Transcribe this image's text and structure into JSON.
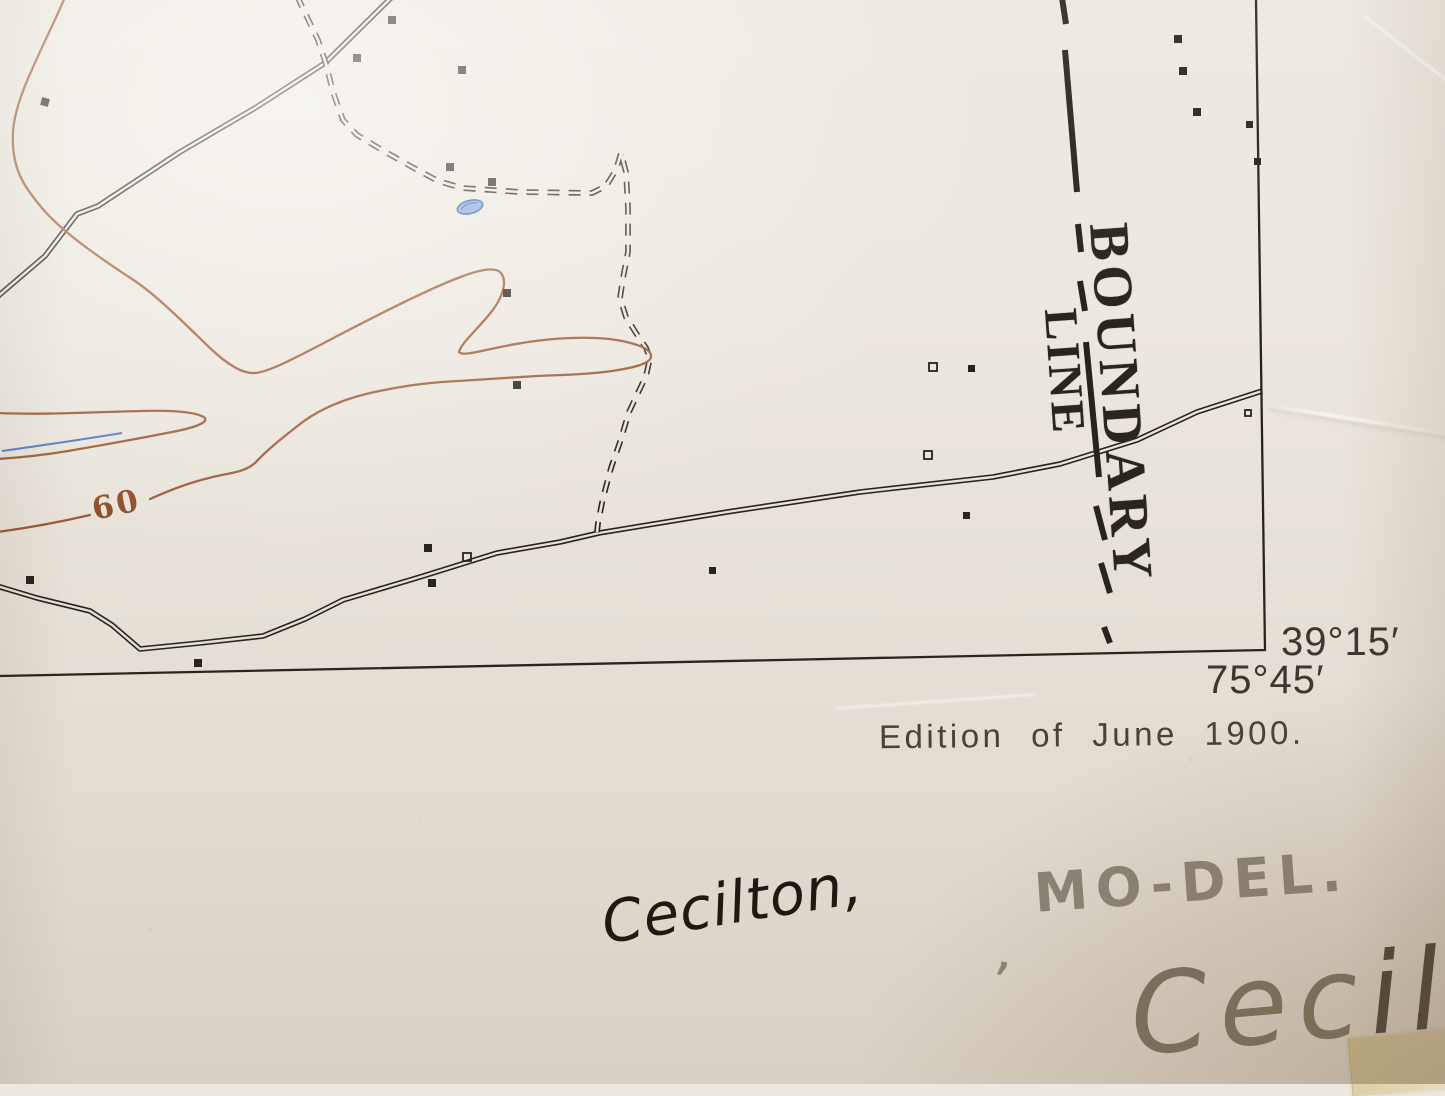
{
  "colors": {
    "paper": "#ece7df",
    "ink": "#26231d",
    "contour_brown": "#9c5a36",
    "water_blue": "#4b7bc2",
    "pencil_gray": "#8f897f",
    "handwriting_ink": "#15120d",
    "tape_yellow": "#d9c48e"
  },
  "map": {
    "boundary_label": {
      "line1": "BOUNDARY",
      "line2": "LINE"
    },
    "contour_label": "60",
    "corner_coordinates": {
      "latitude": "39°15′",
      "longitude": "75°45′"
    },
    "edition_note": "Edition of June 1900."
  },
  "annotations": {
    "handwritten_title_ink": "Cecilton,",
    "handwritten_state_pencil": "MO-DEL.",
    "pencil_mark": ",",
    "partial_pencil_light": "Cec",
    "partial_pencil_dark": "il"
  }
}
